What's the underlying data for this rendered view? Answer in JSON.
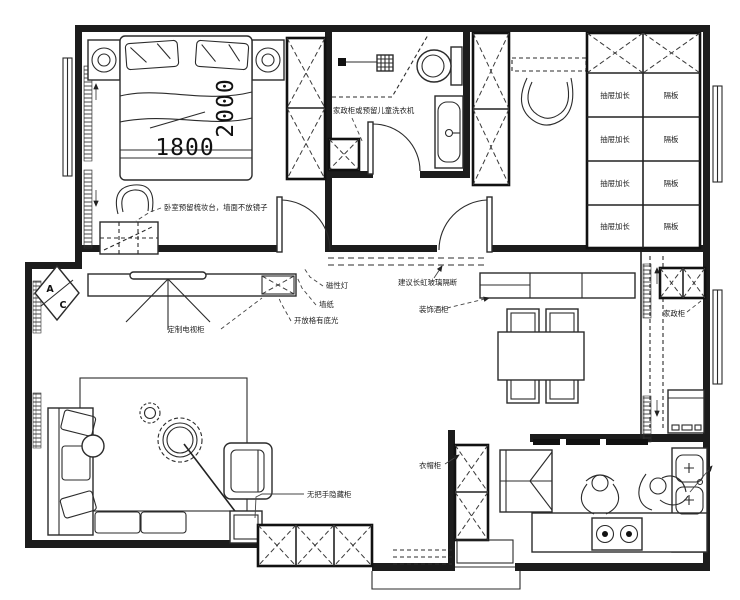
{
  "plan": {
    "bedroom": {
      "bed_width_mm": "1800",
      "bed_length_mm": "2000",
      "dresser_note": "卧室预留梳妆台，墙面不放镜子"
    },
    "bathroom": {
      "cabinet_note": "家政柜或预留儿童洗衣机"
    },
    "cloakroom": {
      "drawer_label": "抽屉加长",
      "shelf_label": "隔板"
    },
    "living_room": {
      "ac_top": "A",
      "ac_bottom": "C",
      "magnetic_light": "磁性灯",
      "wallpaper": "墙纸",
      "open_shelf_light": "开放格有底光",
      "tv_cabinet": "定制电视柜",
      "glass_partition_note": "建议长虹玻璃隔断",
      "wine_cabinet": "装饰酒柜",
      "hidden_cabinet": "无把手隐藏柜"
    },
    "balcony": {
      "utility_cabinet": "家政柜"
    },
    "kitchen": {
      "coat_closet": "衣帽柜"
    }
  }
}
